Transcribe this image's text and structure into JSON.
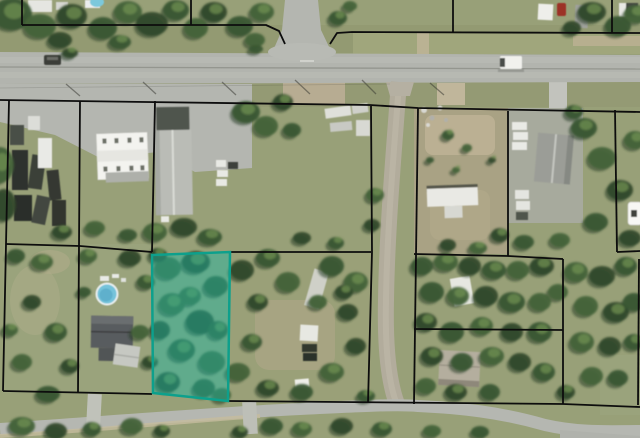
{
  "map": {
    "type": "aerial-parcel-map",
    "description": "Aerial/satellite imagery with black parcel boundary lines and one teal highlighted vacant lot",
    "highlighted_parcel": {
      "polygon": [
        [
          152,
          255
        ],
        [
          230,
          252
        ],
        [
          228,
          401
        ],
        [
          153,
          393
        ]
      ],
      "fill": "#1db9a4",
      "fill_opacity": 0.45,
      "stroke": "#0da08c",
      "stroke_width": 2.5
    },
    "boundary_style": {
      "color": "#0d0d0d",
      "width": 1.8
    },
    "boundaries": [
      [
        [
          22,
          0
        ],
        [
          22,
          25
        ]
      ],
      [
        [
          22,
          25
        ],
        [
          266,
          25
        ],
        [
          279,
          31
        ],
        [
          285,
          44
        ]
      ],
      [
        [
          191,
          0
        ],
        [
          191,
          25
        ]
      ],
      [
        [
          330,
          44
        ],
        [
          337,
          33
        ],
        [
          352,
          32
        ],
        [
          640,
          33
        ]
      ],
      [
        [
          453,
          0
        ],
        [
          453,
          33
        ]
      ],
      [
        [
          612,
          0
        ],
        [
          612,
          33
        ]
      ],
      [
        [
          0,
          100
        ],
        [
          370,
          105
        ],
        [
          418,
          108
        ],
        [
          640,
          112
        ]
      ],
      [
        [
          9,
          101
        ],
        [
          6,
          244
        ],
        [
          3,
          391
        ]
      ],
      [
        [
          80,
          101
        ],
        [
          79,
          246
        ],
        [
          78,
          392
        ]
      ],
      [
        [
          155,
          101
        ],
        [
          152,
          252
        ]
      ],
      [
        [
          6,
          244
        ],
        [
          80,
          246
        ],
        [
          152,
          252
        ]
      ],
      [
        [
          229,
          252
        ],
        [
          371,
          252
        ]
      ],
      [
        [
          371,
          106
        ],
        [
          372,
          252
        ],
        [
          368,
          403
        ]
      ],
      [
        [
          418,
          108
        ],
        [
          414,
          404
        ]
      ],
      [
        [
          414,
          254
        ],
        [
          508,
          256
        ],
        [
          563,
          259
        ]
      ],
      [
        [
          508,
          111
        ],
        [
          508,
          256
        ]
      ],
      [
        [
          563,
          259
        ],
        [
          563,
          404
        ]
      ],
      [
        [
          414,
          329
        ],
        [
          563,
          330
        ]
      ],
      [
        [
          615,
          110
        ],
        [
          617,
          252
        ]
      ],
      [
        [
          617,
          252
        ],
        [
          640,
          251
        ]
      ],
      [
        [
          3,
          391
        ],
        [
          152,
          394
        ]
      ],
      [
        [
          228,
          401
        ],
        [
          563,
          404
        ],
        [
          640,
          407
        ]
      ],
      [
        [
          639,
          259
        ],
        [
          638,
          405
        ]
      ]
    ],
    "colors": {
      "road": "#b2b4ae",
      "dirt_road": "#b2ac9c",
      "grass": "#98a078",
      "field": "#a9a284",
      "gravel": "#b4b6b0",
      "tree_dark": "#31492c",
      "tree_mid": "#3a5633",
      "tree_light": "#6f8f52",
      "pool_water": "#74c3da",
      "highlight_teal": "#1db9a4",
      "boundary_black": "#0d0d0d"
    }
  }
}
